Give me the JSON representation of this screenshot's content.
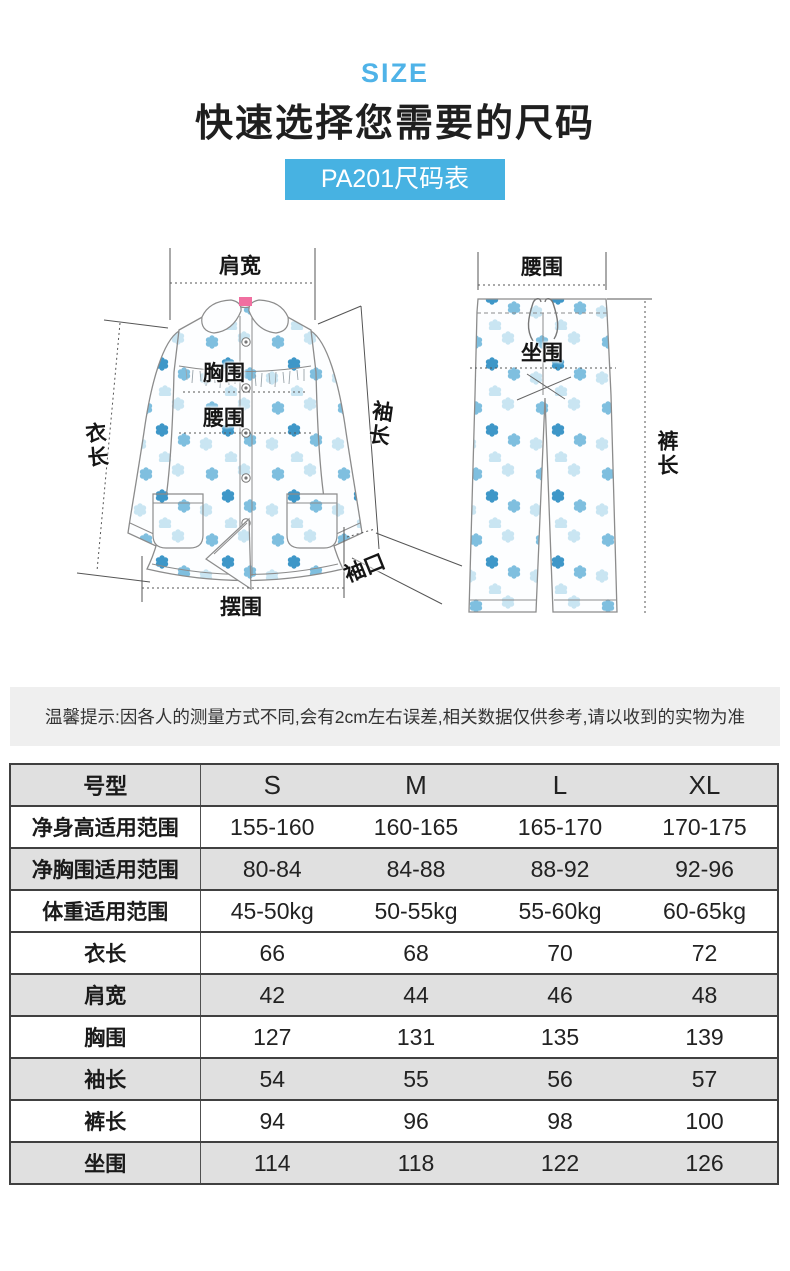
{
  "colors": {
    "accent": "#47B2E2",
    "eyebrow_text": "#4FB3E8",
    "notice_bg": "#EFEFEF",
    "table_gray_row": "#E0E0E0",
    "table_border": "#404040",
    "flower_light": "#C9E5F2",
    "flower_mid": "#7FBFDF",
    "flower_dark": "#3E97C8",
    "garment_outline": "#8C8C8C"
  },
  "header": {
    "eyebrow": "SIZE",
    "title": "快速选择您需要的尺码",
    "badge": "PA201尺码表"
  },
  "diagram": {
    "jacket": {
      "shoulder_width": "肩宽",
      "chest": "胸围",
      "waist": "腰围",
      "garment_length": "衣长",
      "sleeve_length": "袖长",
      "cuff": "袖口",
      "hem": "摆围"
    },
    "pants": {
      "waist": "腰围",
      "hip": "坐围",
      "pants_length": "裤长"
    }
  },
  "notice": "温馨提示:因各人的测量方式不同,会有2cm左右误差,相关数据仅供参考,请以收到的实物为准",
  "size_table": {
    "columns": [
      "号型",
      "S",
      "M",
      "L",
      "XL"
    ],
    "rows": [
      {
        "label": "净身高适用范围",
        "values": [
          "155-160",
          "160-165",
          "165-170",
          "170-175"
        ]
      },
      {
        "label": "净胸围适用范围",
        "values": [
          "80-84",
          "84-88",
          "88-92",
          "92-96"
        ]
      },
      {
        "label": "体重适用范围",
        "values": [
          "45-50kg",
          "50-55kg",
          "55-60kg",
          "60-65kg"
        ]
      },
      {
        "label": "衣长",
        "values": [
          "66",
          "68",
          "70",
          "72"
        ]
      },
      {
        "label": "肩宽",
        "values": [
          "42",
          "44",
          "46",
          "48"
        ]
      },
      {
        "label": "胸围",
        "values": [
          "127",
          "131",
          "135",
          "139"
        ]
      },
      {
        "label": "袖长",
        "values": [
          "54",
          "55",
          "56",
          "57"
        ]
      },
      {
        "label": "裤长",
        "values": [
          "94",
          "96",
          "98",
          "100"
        ]
      },
      {
        "label": "坐围",
        "values": [
          "114",
          "118",
          "122",
          "126"
        ]
      }
    ]
  }
}
